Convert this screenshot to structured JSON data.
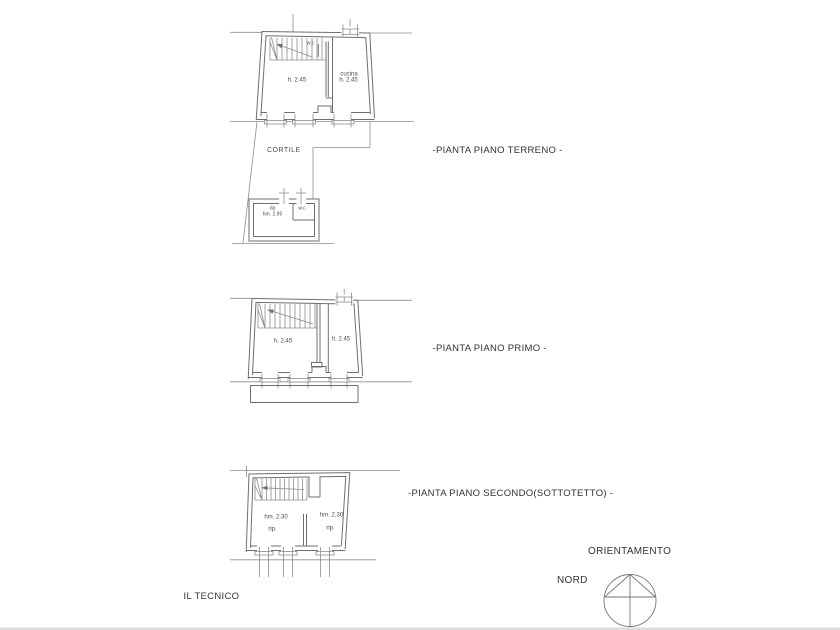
{
  "colors": {
    "background": "#ffffff",
    "line": "#8d8d8d",
    "wall": "#6f6f6f",
    "title_text": "#333333",
    "room_text": "#4d4d4d",
    "bottom_edge": "#dcdcdc"
  },
  "plan_terreno": {
    "title": "-PIANTA PIANO TERRENO -",
    "wc": "w.c",
    "main_height": "h. 2.45",
    "kitchen": "cucina",
    "kitchen_height": "h. 2.45",
    "courtyard": "CORTILE",
    "annex_storage": "rip",
    "annex_height": "hm. 2.95",
    "annex_wc": "w.c"
  },
  "plan_primo": {
    "title": "-PIANTA PIANO PRIMO -",
    "left_height": "h. 2.45",
    "right_height": "h. 2.45"
  },
  "plan_secondo": {
    "title": "-PIANTA PIANO SECONDO(SOTTOTETTO) -",
    "left_height": "hm. 2.30",
    "left_room": "rip.",
    "right_height": "hm. 2.30",
    "right_room": "rip."
  },
  "orientation": {
    "title": "ORIENTAMENTO",
    "north": "NORD"
  },
  "signature": "IL TECNICO"
}
